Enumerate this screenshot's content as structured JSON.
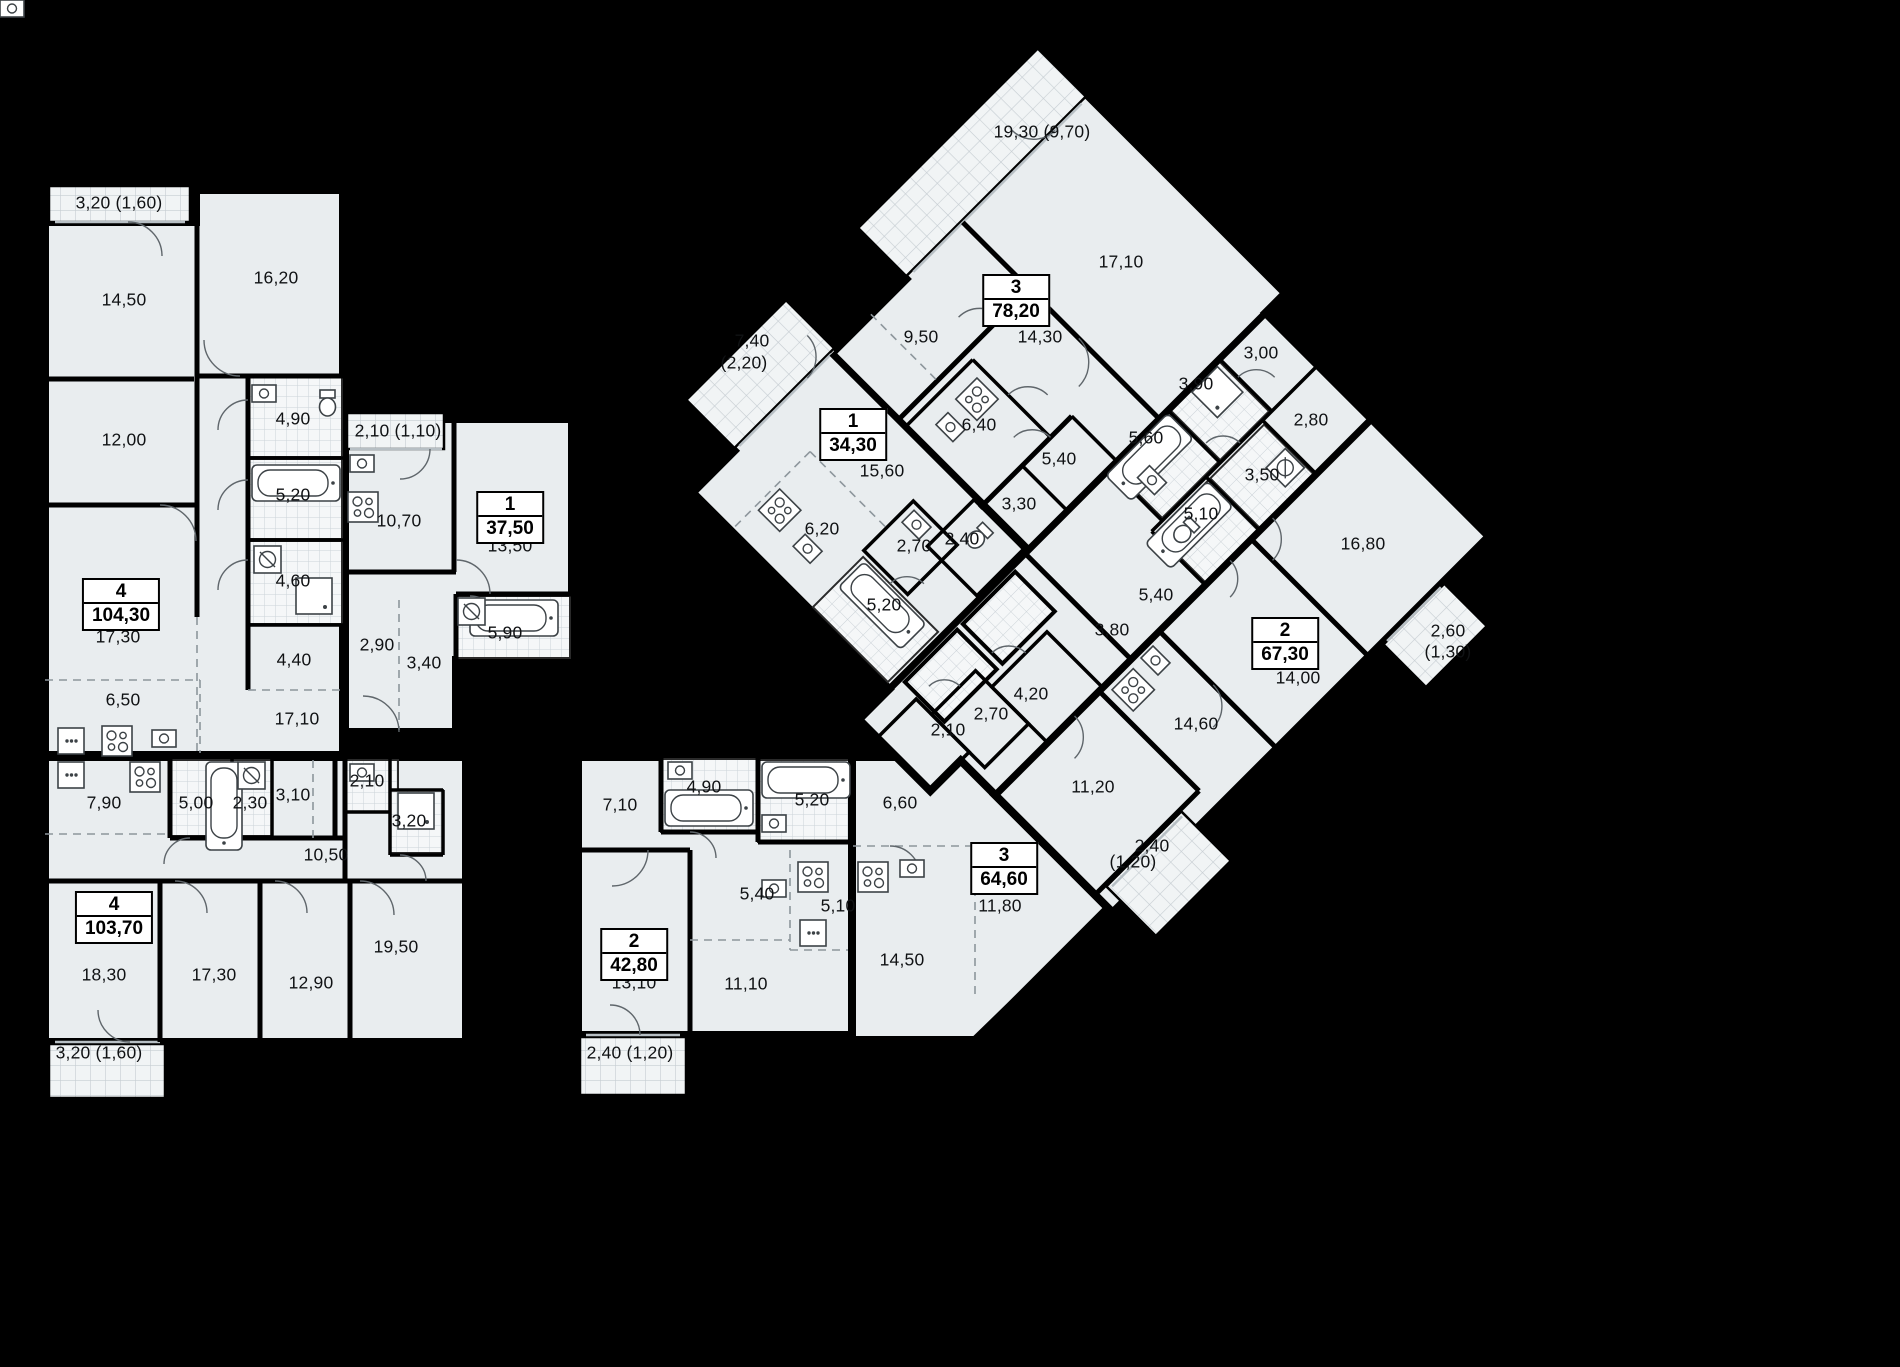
{
  "plan": {
    "type": "residential-floor-plan",
    "background_color": "#000000",
    "apartment_fill": "#e9edef",
    "wall_color": "#000000",
    "apartments": [
      {
        "rooms_count": "4",
        "area": "104,30",
        "x": 121,
        "y": 578
      },
      {
        "rooms_count": "1",
        "area": "37,50",
        "x": 510,
        "y": 491
      },
      {
        "rooms_count": "4",
        "area": "103,70",
        "x": 114,
        "y": 891
      },
      {
        "rooms_count": "2",
        "area": "42,80",
        "x": 634,
        "y": 928
      },
      {
        "rooms_count": "3",
        "area": "64,60",
        "x": 1004,
        "y": 842
      },
      {
        "rooms_count": "3",
        "area": "78,20",
        "x": 1016,
        "y": 274
      },
      {
        "rooms_count": "1",
        "area": "34,30",
        "x": 853,
        "y": 408
      },
      {
        "rooms_count": "2",
        "area": "67,30",
        "x": 1285,
        "y": 617
      }
    ],
    "area_labels": [
      {
        "text": "3,20 (1,60)",
        "x": 119,
        "y": 203
      },
      {
        "text": "14,50",
        "x": 124,
        "y": 300
      },
      {
        "text": "16,20",
        "x": 276,
        "y": 278
      },
      {
        "text": "12,00",
        "x": 124,
        "y": 440
      },
      {
        "text": "4,90",
        "x": 293,
        "y": 419
      },
      {
        "text": "5,20",
        "x": 293,
        "y": 495
      },
      {
        "text": "4,60",
        "x": 293,
        "y": 581
      },
      {
        "text": "17,30",
        "x": 118,
        "y": 637
      },
      {
        "text": "6,50",
        "x": 123,
        "y": 700
      },
      {
        "text": "4,40",
        "x": 294,
        "y": 660
      },
      {
        "text": "17,10",
        "x": 297,
        "y": 719
      },
      {
        "text": "2,10 (1,10)",
        "x": 398,
        "y": 431
      },
      {
        "text": "10,70",
        "x": 399,
        "y": 521
      },
      {
        "text": "13,50",
        "x": 510,
        "y": 546
      },
      {
        "text": "2,90",
        "x": 377,
        "y": 645
      },
      {
        "text": "3,40",
        "x": 424,
        "y": 663
      },
      {
        "text": "5,90",
        "x": 505,
        "y": 633
      },
      {
        "text": "7,90",
        "x": 104,
        "y": 803
      },
      {
        "text": "5,00",
        "x": 196,
        "y": 803
      },
      {
        "text": "2,30",
        "x": 250,
        "y": 803
      },
      {
        "text": "3,10",
        "x": 293,
        "y": 795
      },
      {
        "text": "2,10",
        "x": 367,
        "y": 781
      },
      {
        "text": "3,20",
        "x": 409,
        "y": 821
      },
      {
        "text": "10,50",
        "x": 326,
        "y": 855
      },
      {
        "text": "18,30",
        "x": 104,
        "y": 975
      },
      {
        "text": "17,30",
        "x": 214,
        "y": 975
      },
      {
        "text": "12,90",
        "x": 311,
        "y": 983
      },
      {
        "text": "19,50",
        "x": 396,
        "y": 947
      },
      {
        "text": "3,20 (1,60)",
        "x": 99,
        "y": 1053
      },
      {
        "text": "7,10",
        "x": 620,
        "y": 805
      },
      {
        "text": "4,90",
        "x": 704,
        "y": 787
      },
      {
        "text": "5,20",
        "x": 812,
        "y": 800
      },
      {
        "text": "13,10",
        "x": 634,
        "y": 983
      },
      {
        "text": "11,10",
        "x": 746,
        "y": 984
      },
      {
        "text": "5,40",
        "x": 757,
        "y": 894
      },
      {
        "text": "5,10",
        "x": 838,
        "y": 906
      },
      {
        "text": "2,40 (1,20)",
        "x": 630,
        "y": 1053
      },
      {
        "text": "6,60",
        "x": 900,
        "y": 803
      },
      {
        "text": "11,80",
        "x": 1000,
        "y": 906
      },
      {
        "text": "14,50",
        "x": 902,
        "y": 960
      },
      {
        "text": "2,40",
        "x": 1152,
        "y": 846
      },
      {
        "text": "(1,20)",
        "x": 1133,
        "y": 862
      },
      {
        "text": "19,30 (9,70)",
        "x": 1042,
        "y": 132
      },
      {
        "text": "17,10",
        "x": 1121,
        "y": 262
      },
      {
        "text": "14,30",
        "x": 1040,
        "y": 337
      },
      {
        "text": "9,50",
        "x": 921,
        "y": 337
      },
      {
        "text": "6,40",
        "x": 979,
        "y": 425
      },
      {
        "text": "5,40",
        "x": 1059,
        "y": 459
      },
      {
        "text": "3,30",
        "x": 1019,
        "y": 504
      },
      {
        "text": "7,40",
        "x": 752,
        "y": 341
      },
      {
        "text": "(2,20)",
        "x": 744,
        "y": 363
      },
      {
        "text": "15,60",
        "x": 882,
        "y": 471
      },
      {
        "text": "6,20",
        "x": 822,
        "y": 529
      },
      {
        "text": "2,70",
        "x": 914,
        "y": 546
      },
      {
        "text": "2,40",
        "x": 962,
        "y": 539
      },
      {
        "text": "5,20",
        "x": 884,
        "y": 605
      },
      {
        "text": "3,00",
        "x": 1261,
        "y": 353
      },
      {
        "text": "3,90",
        "x": 1196,
        "y": 384
      },
      {
        "text": "5,60",
        "x": 1146,
        "y": 438
      },
      {
        "text": "2,80",
        "x": 1311,
        "y": 420
      },
      {
        "text": "3,50",
        "x": 1262,
        "y": 475
      },
      {
        "text": "5,10",
        "x": 1201,
        "y": 514
      },
      {
        "text": "16,80",
        "x": 1363,
        "y": 544
      },
      {
        "text": "5,40",
        "x": 1156,
        "y": 595
      },
      {
        "text": "3,80",
        "x": 1112,
        "y": 630
      },
      {
        "text": "14,00",
        "x": 1298,
        "y": 678
      },
      {
        "text": "2,60",
        "x": 1448,
        "y": 631
      },
      {
        "text": "(1,30)",
        "x": 1448,
        "y": 652
      },
      {
        "text": "4,20",
        "x": 1031,
        "y": 694
      },
      {
        "text": "2,70",
        "x": 991,
        "y": 714
      },
      {
        "text": "2,10",
        "x": 948,
        "y": 730
      },
      {
        "text": "11,20",
        "x": 1093,
        "y": 787
      },
      {
        "text": "14,60",
        "x": 1196,
        "y": 724
      }
    ]
  }
}
